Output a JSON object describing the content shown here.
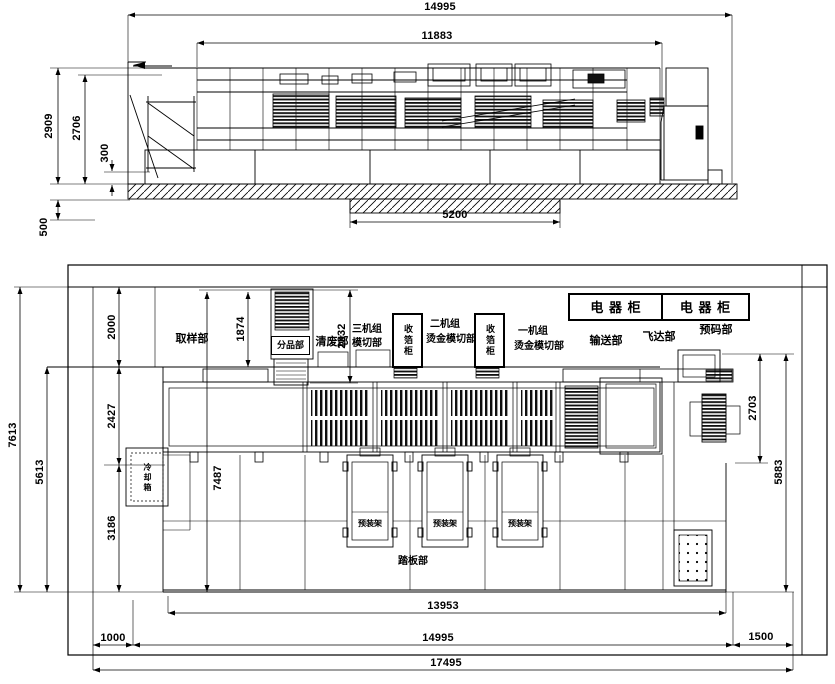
{
  "side_view": {
    "dims": {
      "overall": "14995",
      "machine": "11883",
      "h_total": "2909",
      "h_body": "2706",
      "base": "300",
      "pit_depth": "500",
      "pit_len": "5200"
    }
  },
  "plan_view": {
    "dims": {
      "outer_left": "7613",
      "inner_left": "5613",
      "zone_top": "2000",
      "zone_mid": "2427",
      "zone_bottom": "3186",
      "machine_width": "7487",
      "tower": "1874",
      "stripper": "2332",
      "right_upper": "2703",
      "right_full": "5883",
      "inner_length": "13953",
      "machine_length": "14995",
      "margin_left": "1000",
      "margin_right": "1500",
      "total_length": "17495"
    },
    "labels": {
      "sampling": "取样部",
      "sorting": "分品部",
      "stripping": "清废部",
      "unit3_l1": "三机组",
      "unit3_l2": "模切部",
      "foil_cabinet": "收箔柜",
      "unit2_l1": "二机组",
      "unit2_l2": "烫金模切部",
      "unit1_l1": "一机组",
      "unit1_l2": "烫金模切部",
      "conveying": "输送部",
      "feeder": "飞达部",
      "prestacker": "预码部",
      "electrical_cabinet": "电 器 柜",
      "die_cart": "预装架",
      "platform": "踏板部",
      "cooler": "冷却箱"
    }
  }
}
